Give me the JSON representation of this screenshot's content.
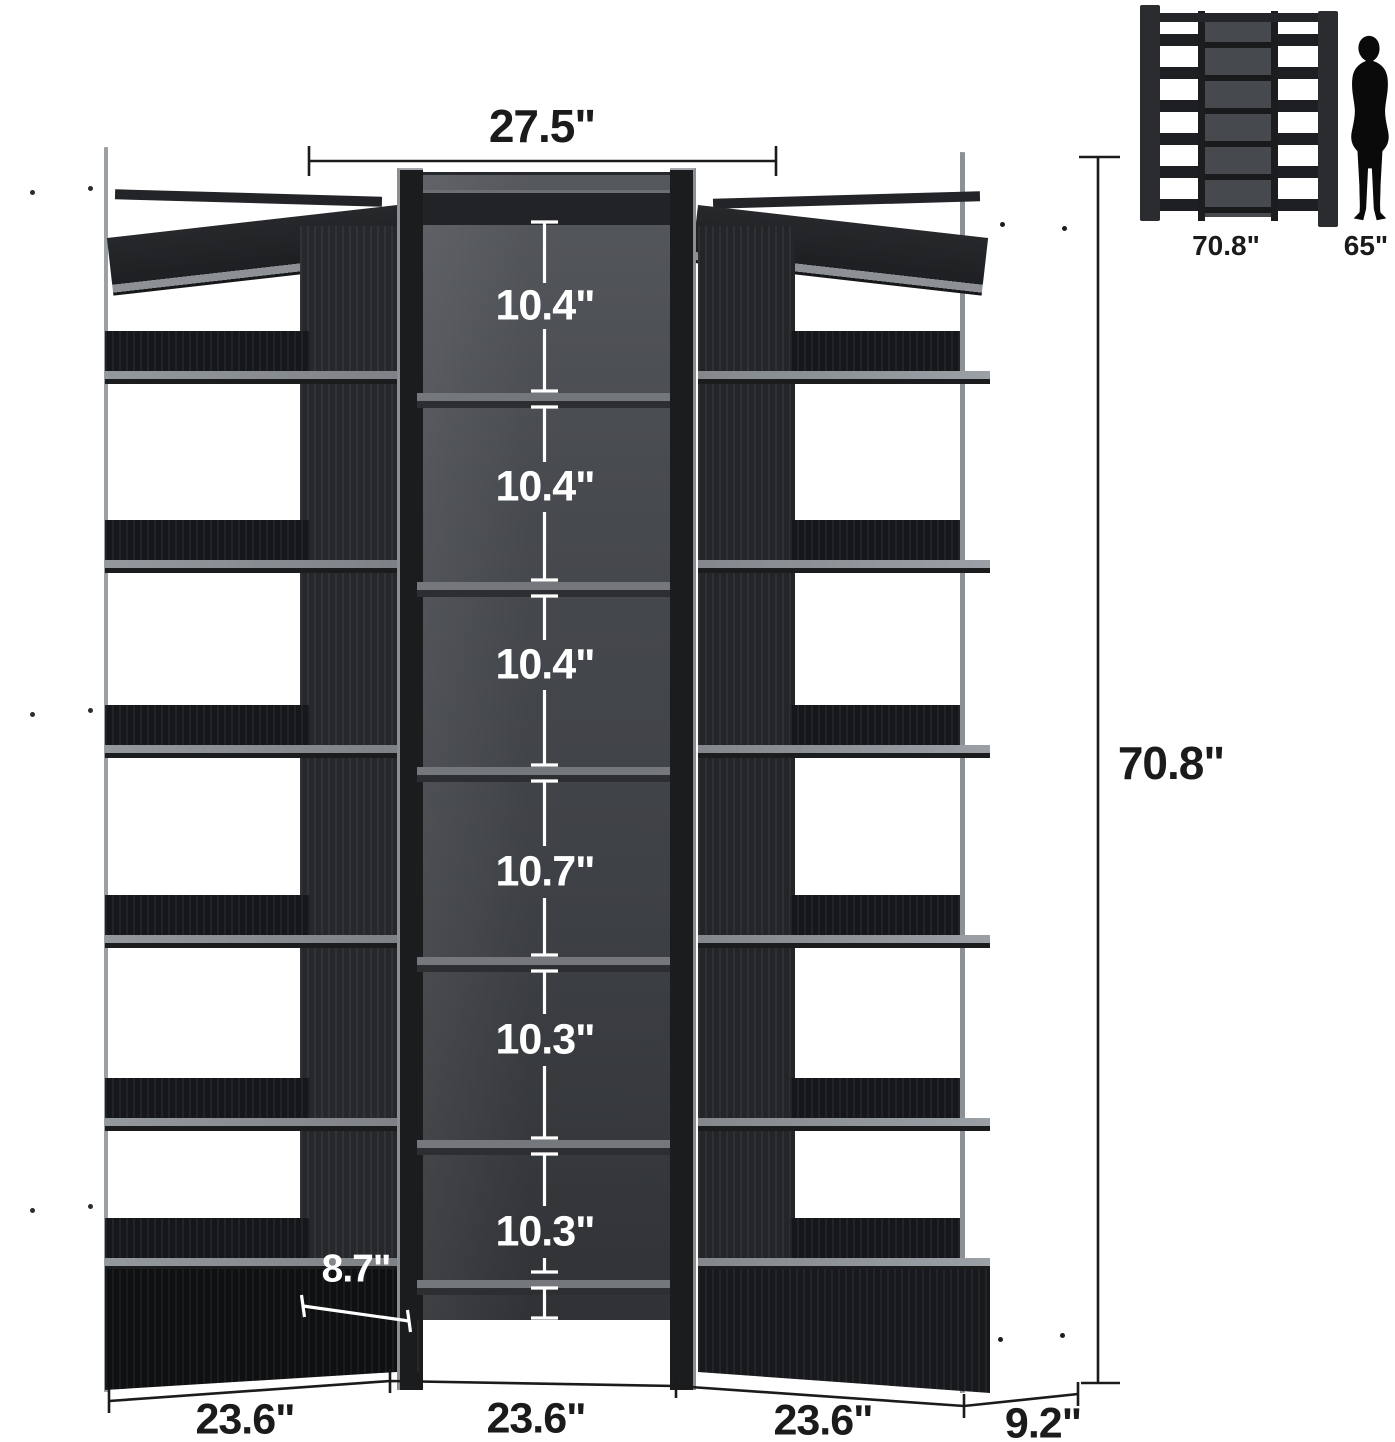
{
  "product_diagram": {
    "top_width": "27.5\"",
    "total_height": "70.8\"",
    "shelf_gaps": [
      "10.4\"",
      "10.4\"",
      "10.4\"",
      "10.7\"",
      "10.3\"",
      "10.3\""
    ],
    "base_height": "2.3\"",
    "shelf_depth": "8.7\"",
    "bottom_width_left": "23.6\"",
    "bottom_width_center": "23.6\"",
    "bottom_width_right": "23.6\"",
    "side_depth": "9.2\"",
    "accent_line_dark": "#1b1b1b",
    "accent_line_light": "#ffffff"
  },
  "inset": {
    "unit_height": "70.8\"",
    "person_height": "65\""
  }
}
